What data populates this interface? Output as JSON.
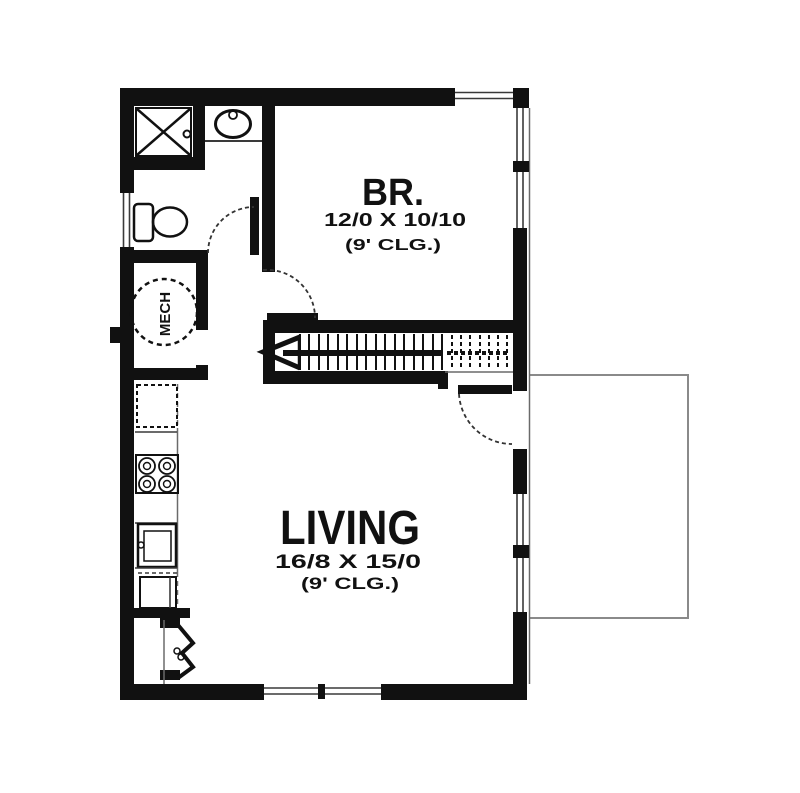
{
  "plan_title": "Floor plan",
  "labels": {
    "bedroom": {
      "name": "BR.",
      "dims": "12/0 X 10/10",
      "ceiling": "(9' CLG.)"
    },
    "living": {
      "name": "LIVING",
      "dims": "16/8 X 15/0",
      "ceiling": "(9' CLG.)"
    },
    "mech": {
      "name": "MECH"
    }
  },
  "fixtures": [
    "shower",
    "toilet",
    "bath-sink",
    "water-heater",
    "refrigerator",
    "range",
    "kitchen-sink",
    "dishwasher",
    "closet-bifold-door",
    "stairs",
    "stair-direction-arrow",
    "entry-door",
    "bedroom-door",
    "bathroom-door",
    "deck-outline"
  ],
  "colors": {
    "ink": "#111111",
    "window_line": "#3a3a3a",
    "deck_line": "#8a8a8a",
    "background": "#ffffff"
  }
}
